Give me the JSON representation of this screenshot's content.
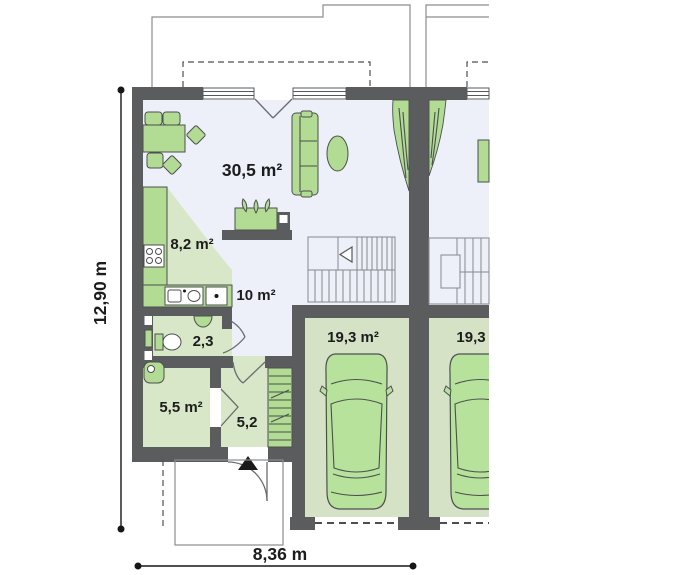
{
  "plan": {
    "type": "architectural-floor-plan",
    "rooms": {
      "living": {
        "label": "30,5 m²"
      },
      "kitchen": {
        "label": "8,2 m²"
      },
      "hall": {
        "label": "10 m²"
      },
      "wc": {
        "label": "2,3"
      },
      "utility": {
        "label": "5,5 m²"
      },
      "entry": {
        "label": "5,2"
      },
      "garage_left": {
        "label": "19,3 m²"
      },
      "garage_right": {
        "label": "19,3"
      }
    },
    "dimensions": {
      "height": "12,90 m",
      "width": "8,36 m"
    },
    "colors": {
      "wall": "#5b5c5e",
      "floor_light": "#edf0f8",
      "floor_green": "#d9e7c9",
      "garage_green": "#d5e2c6",
      "furniture": "#b2db93",
      "car": "#b7e29b",
      "outline": "#4c4f52",
      "thin_line": "#8a8d90",
      "text": "#1c1c1c"
    }
  }
}
